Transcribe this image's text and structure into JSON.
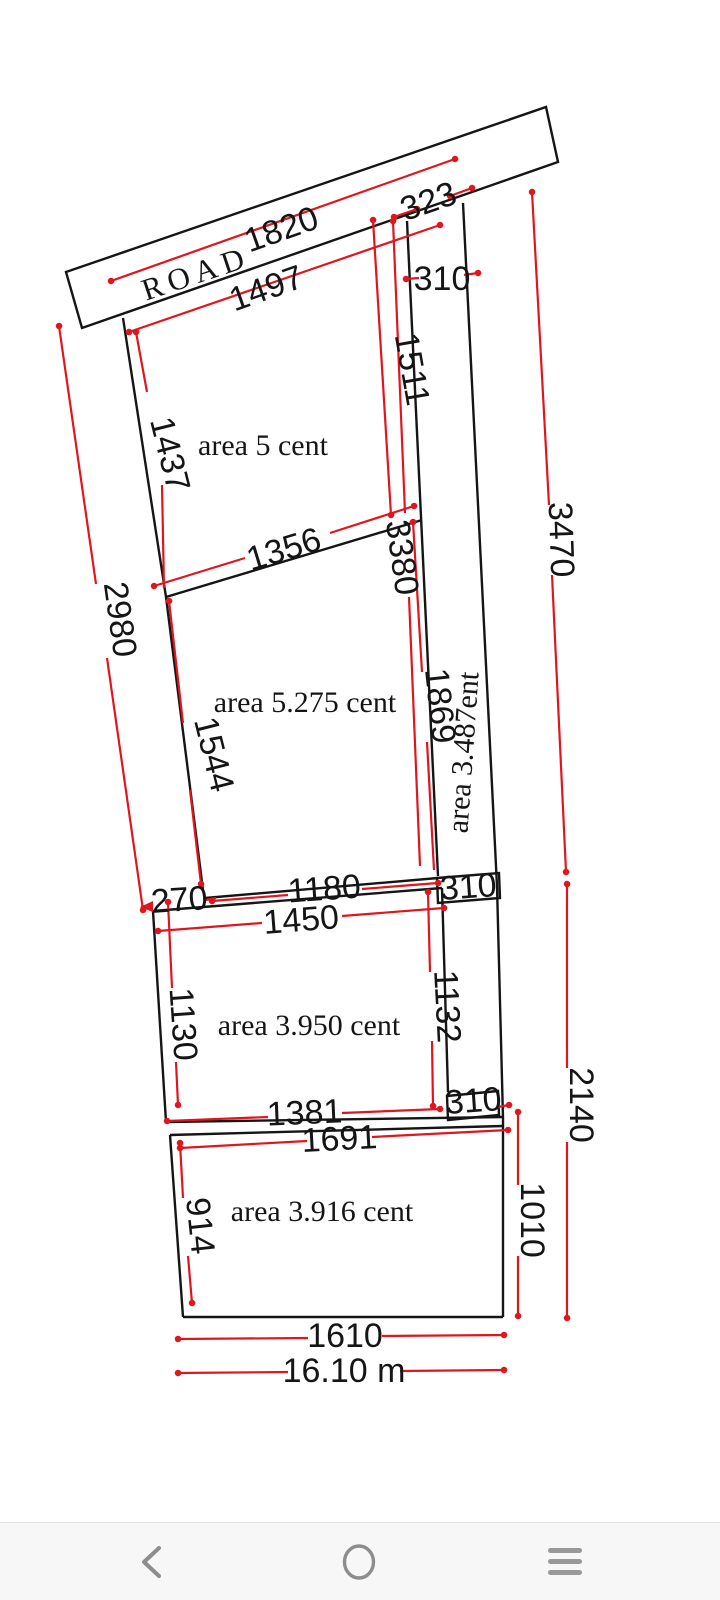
{
  "colors": {
    "black": "#151515",
    "red": "#e0161f",
    "gray_dim": "#3c3c3c",
    "nav_icon": "#8d8d8d",
    "nav_bg": "#f7f7f8"
  },
  "road": {
    "label": "ROAD"
  },
  "plots": {
    "plot_a_area": "area 5 cent",
    "plot_b_area": "area 5.275 cent",
    "strip_area": "area 3.487ent",
    "plot_c_area": "area 3.950 cent",
    "plot_d_area": "area 3.916 cent"
  },
  "dims": {
    "road_frontage": "1820",
    "plot_a_top": "1497",
    "corridor_frontage": "323",
    "corridor_width_top": "310",
    "plot_a_right": "1511",
    "plot_a_left": "1437",
    "left_total": "2980",
    "right_total_upper": "3470",
    "ab_divider": "1356",
    "right_ab_total": "3380",
    "plot_b_left": "1544",
    "plot_b_right": "1869",
    "offset": "270",
    "plot_b_bottom": "1180",
    "corridor_width_mid": "310",
    "plot_c_top": "1450",
    "plot_c_left": "1130",
    "plot_c_right": "1132",
    "corridor_width_low": "310",
    "plot_c_bottom": "1381",
    "plot_d_top": "1691",
    "plot_d_left": "914",
    "plot_d_right": "1010",
    "right_total_lower": "2140",
    "plot_d_bottom": "1610",
    "total_width_m": "16.10 m"
  },
  "nav": {
    "back": "back",
    "home": "home",
    "menu": "menu"
  }
}
